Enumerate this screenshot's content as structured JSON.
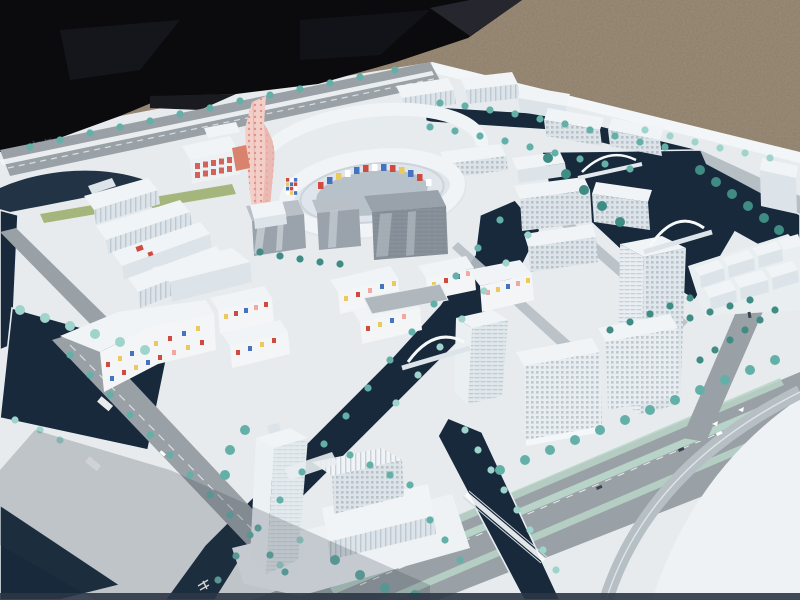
{
  "meta": {
    "width": 800,
    "height": 600,
    "kind": "photograph"
  },
  "scene": {
    "description": "Outdoor photograph of a white architectural scale model of a waterfront urban master plan, viewed at an oblique aerial angle. The model board sits on gravel ground with a black tarpaulin at the upper left. White acrylic buildings, dark navy canals, teal glass trees, grey roads, arched bridges, a curved flyover ramp and a blank white plaza are visible.",
    "background": {
      "top_left": "black tarpaulin cover",
      "top_right": "brown gravel ground",
      "base": "white model board"
    },
    "landmarks": [
      {
        "name": "twisted pink landmark tower with red dot facade"
      },
      {
        "name": "elliptical ring complex with multicoloured mosaic courtyard"
      },
      {
        "name": "grey reflective-glass office slabs"
      },
      {
        "name": "white high-rise tower cluster by the canal (east)"
      },
      {
        "name": "translucent white tower with stepped podium (south)"
      },
      {
        "name": "low-rise housing blocks with scattered coloured windows (southwest)"
      },
      {
        "name": "white arched lattice bridges over the canals"
      },
      {
        "name": "curved flyover ramp and wide boulevard (southeast)"
      },
      {
        "name": "blank white plaza area (bottom right corner)"
      },
      {
        "name": "rows of teal model trees along roads and quays"
      }
    ]
  },
  "signage": [
    {
      "location": "board top-left corner",
      "content": "small dark stamped characters (illegible)"
    },
    {
      "location": "southwest road",
      "content": "white street-name plates (illegible)"
    },
    {
      "location": "south road surface",
      "content": "white pavement glyph (illegible)"
    }
  ],
  "palette": {
    "gravel": "#8c7c68",
    "tarp": "#0b0b0e",
    "board": "#e7ebee",
    "board-bright": "#f3f6f8",
    "water": "#17293b",
    "road": "#99a1a7",
    "road-light": "#b6bfc4",
    "median": "#b8d3c7",
    "tree": "#63b0a8",
    "tree-light": "#9ed4cc",
    "tree-dark": "#3f8c85",
    "bldg": "#f1f4f6",
    "bldg-side": "#dde4e9",
    "bldg-shade": "#c9d2d8",
    "glass": "#9aa3ac",
    "glass-dark": "#848d96",
    "pink": "#f2cfc9",
    "pink-dot": "#e2847a",
    "accent-red": "#cf4b40",
    "accent-blue": "#4673c0",
    "accent-yellow": "#ecc95d",
    "accent-pink": "#f2a8a0",
    "lawn": "#9cb06f",
    "shadow": "#303b4a"
  }
}
